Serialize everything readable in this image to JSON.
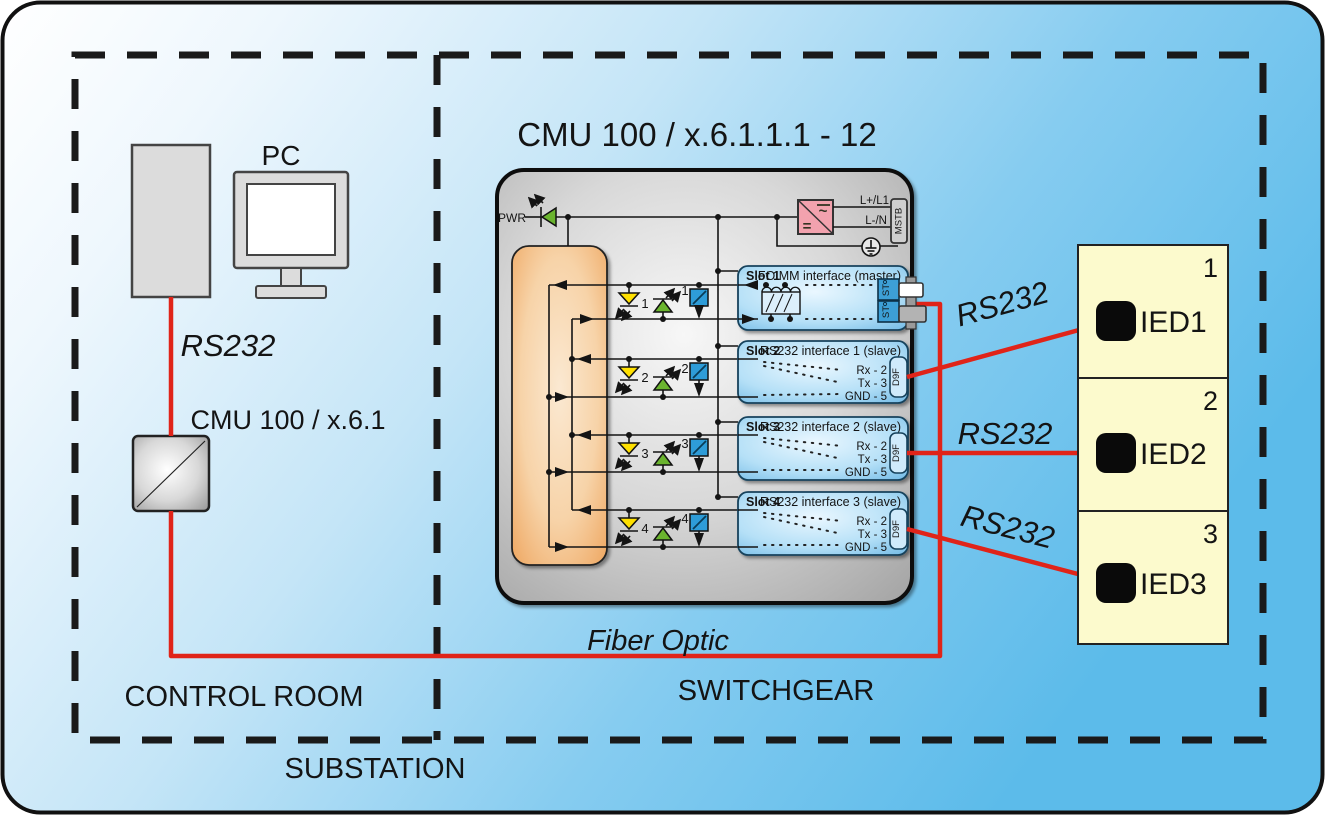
{
  "labels": {
    "substation": "SUBSTATION",
    "control_room": "CONTROL ROOM",
    "switchgear": "SWITCHGEAR"
  },
  "control_room": {
    "pc": "PC",
    "rs232": "RS232",
    "converter": "CMU 100 / x.6.1"
  },
  "links": {
    "fiber": "Fiber Optic",
    "rs232": "RS232"
  },
  "cmu": {
    "title": "CMU 100 / x.6.1.1.1 - 12",
    "pwr": "PWR",
    "power_supply": {
      "ac": "~",
      "dc": "=",
      "line_plus": "L+/L1",
      "line_neutral": "L-/N",
      "connector": "MSTB"
    },
    "channels": [
      "1",
      "2",
      "3",
      "4"
    ],
    "slots": [
      {
        "name": "Slot 1",
        "title": "FO MM interface (master)",
        "connector": "ST"
      },
      {
        "name": "Slot 2",
        "title": "RS232 interface 1 (slave)",
        "connector": "D9F",
        "pins": [
          "Rx - 2",
          "Tx - 3",
          "GND - 5"
        ]
      },
      {
        "name": "Slot 3",
        "title": "RS232 interface 2 (slave)",
        "connector": "D9F",
        "pins": [
          "Rx - 2",
          "Tx - 3",
          "GND - 5"
        ]
      },
      {
        "name": "Slot 4",
        "title": "RS232 interface 3 (slave)",
        "connector": "D9F",
        "pins": [
          "Rx - 2",
          "Tx - 3",
          "GND - 5"
        ]
      }
    ]
  },
  "ieds": [
    {
      "number": "1",
      "label": "IED1"
    },
    {
      "number": "2",
      "label": "IED2"
    },
    {
      "number": "3",
      "label": "IED3"
    }
  ],
  "colors": {
    "link_red": "#e02419",
    "background_blue": "#5cbbea",
    "slot_blue": "#57abdf",
    "panel_orange": "#eea55e",
    "ied_yellow": "#fcfacd",
    "supply_pink": "#f2a2ae"
  }
}
